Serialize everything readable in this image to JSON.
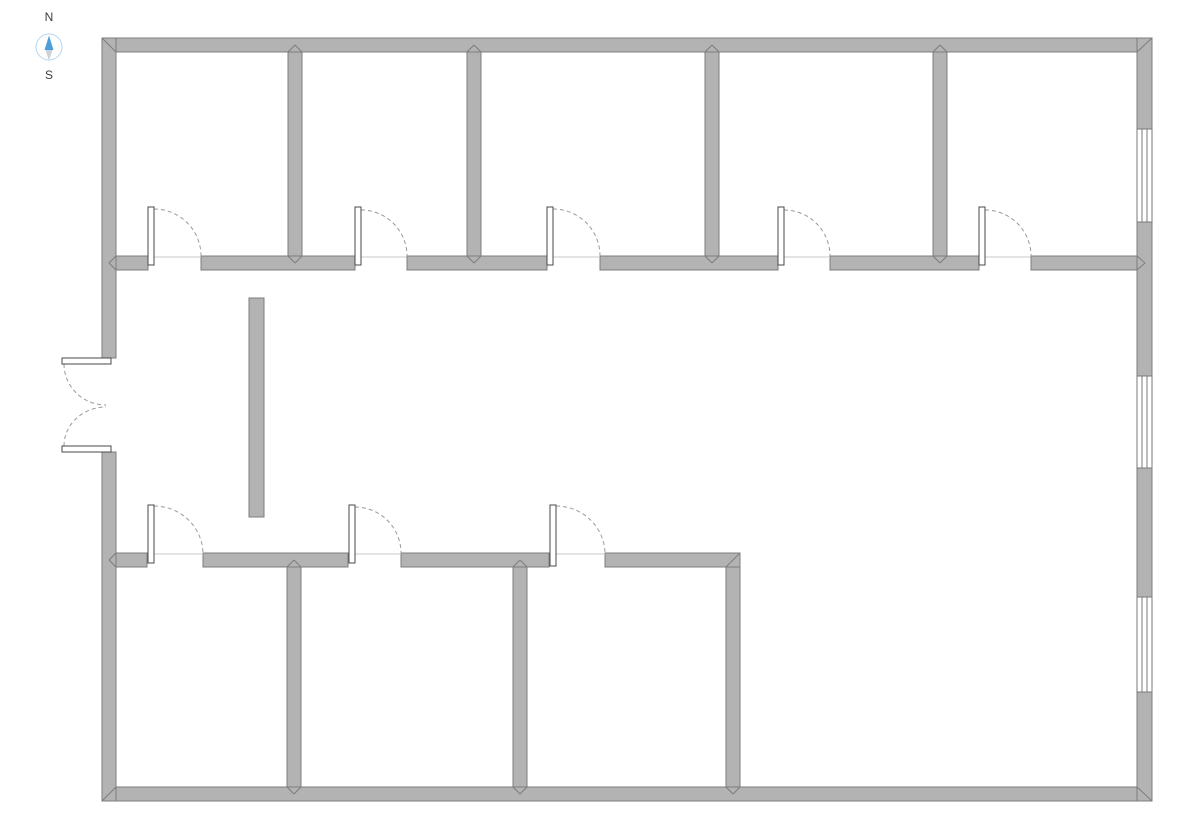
{
  "canvas": {
    "width": 1191,
    "height": 831,
    "background": "#ffffff"
  },
  "colors": {
    "wall_fill": "#b3b3b3",
    "wall_stroke": "#7d7d7d",
    "door_leaf_fill": "#ffffff",
    "door_leaf_stroke": "#4a4a4a",
    "door_arc": "#9a9a9a",
    "opening_line": "#c8c8c8",
    "window_fill": "#ffffff",
    "window_stroke": "#787878",
    "compass_circle": "#b3d6ef",
    "compass_north": "#4ba0da",
    "compass_south": "#ccd1d5",
    "compass_text": "#3e3e3e"
  },
  "compass": {
    "cx": 49,
    "cy": 47,
    "r": 13,
    "north_label": "N",
    "south_label": "S",
    "north_points": "49,35.5 44.5,50 53.5,50",
    "south_points": "45.5,50 52.5,50 49,60.5",
    "north_label_pos": {
      "x": 49,
      "y": 21
    },
    "south_label_pos": {
      "x": 49,
      "y": 79
    },
    "font_size": 12
  },
  "floorplan": {
    "walls": [
      {
        "id": "exterior-top",
        "x": 102,
        "y": 38,
        "w": 1050,
        "h": 14
      },
      {
        "id": "exterior-bottom",
        "x": 102,
        "y": 787,
        "w": 1050,
        "h": 14
      },
      {
        "id": "exterior-left-upper",
        "x": 102,
        "y": 38,
        "w": 14,
        "h": 320
      },
      {
        "id": "exterior-left-lower",
        "x": 102,
        "y": 452,
        "w": 14,
        "h": 349
      },
      {
        "id": "exterior-right",
        "x": 1137,
        "y": 38,
        "w": 15,
        "h": 763
      },
      {
        "id": "corridor-left-stub",
        "x": 116,
        "y": 256,
        "w": 32,
        "h": 14
      },
      {
        "id": "corridor-seg-1",
        "x": 201,
        "y": 256,
        "w": 154,
        "h": 14
      },
      {
        "id": "corridor-seg-2",
        "x": 407,
        "y": 256,
        "w": 140,
        "h": 14
      },
      {
        "id": "corridor-seg-3",
        "x": 600,
        "y": 256,
        "w": 178,
        "h": 14
      },
      {
        "id": "corridor-seg-4",
        "x": 830,
        "y": 256,
        "w": 149,
        "h": 14
      },
      {
        "id": "corridor-seg-5",
        "x": 1031,
        "y": 256,
        "w": 106,
        "h": 14
      },
      {
        "id": "north-partition-1",
        "x": 288,
        "y": 52,
        "w": 14,
        "h": 204
      },
      {
        "id": "north-partition-2",
        "x": 467,
        "y": 52,
        "w": 14,
        "h": 204
      },
      {
        "id": "north-partition-3",
        "x": 705,
        "y": 52,
        "w": 14,
        "h": 204
      },
      {
        "id": "north-partition-4",
        "x": 933,
        "y": 52,
        "w": 14,
        "h": 204
      },
      {
        "id": "south-wing-left-stub",
        "x": 116,
        "y": 553,
        "w": 31,
        "h": 14
      },
      {
        "id": "south-wing-seg-1",
        "x": 203,
        "y": 553,
        "w": 145,
        "h": 14
      },
      {
        "id": "south-wing-seg-2",
        "x": 401,
        "y": 553,
        "w": 148,
        "h": 14
      },
      {
        "id": "south-wing-seg-3",
        "x": 605,
        "y": 553,
        "w": 135,
        "h": 14
      },
      {
        "id": "south-partition-1",
        "x": 287,
        "y": 567,
        "w": 14,
        "h": 220
      },
      {
        "id": "south-partition-2",
        "x": 513,
        "y": 567,
        "w": 14,
        "h": 220
      },
      {
        "id": "south-wing-right",
        "x": 726,
        "y": 567,
        "w": 14,
        "h": 220
      },
      {
        "id": "free-standing-wall",
        "x": 249,
        "y": 298,
        "w": 15,
        "h": 219
      }
    ],
    "miters": [
      [
        102,
        38,
        116,
        52
      ],
      [
        1152,
        38,
        1137,
        52
      ],
      [
        102,
        801,
        116,
        787
      ],
      [
        1152,
        801,
        1137,
        787
      ],
      [
        288,
        52,
        295,
        45
      ],
      [
        302,
        52,
        295,
        45
      ],
      [
        467,
        52,
        474,
        45
      ],
      [
        481,
        52,
        474,
        45
      ],
      [
        705,
        52,
        712,
        45
      ],
      [
        719,
        52,
        712,
        45
      ],
      [
        933,
        52,
        940,
        45
      ],
      [
        947,
        52,
        940,
        45
      ],
      [
        288,
        256,
        295,
        263
      ],
      [
        302,
        256,
        295,
        263
      ],
      [
        467,
        256,
        474,
        263
      ],
      [
        481,
        256,
        474,
        263
      ],
      [
        705,
        256,
        712,
        263
      ],
      [
        719,
        256,
        712,
        263
      ],
      [
        933,
        256,
        940,
        263
      ],
      [
        947,
        256,
        940,
        263
      ],
      [
        116,
        256,
        109,
        263
      ],
      [
        116,
        270,
        109,
        263
      ],
      [
        1137,
        256,
        1145,
        263
      ],
      [
        1137,
        270,
        1145,
        263
      ],
      [
        116,
        553,
        109,
        560
      ],
      [
        116,
        567,
        109,
        560
      ],
      [
        287,
        567,
        294,
        560
      ],
      [
        301,
        567,
        294,
        560
      ],
      [
        513,
        567,
        520,
        560
      ],
      [
        527,
        567,
        520,
        560
      ],
      [
        287,
        787,
        294,
        794
      ],
      [
        301,
        787,
        294,
        794
      ],
      [
        513,
        787,
        520,
        794
      ],
      [
        527,
        787,
        520,
        794
      ],
      [
        726,
        787,
        733,
        794
      ],
      [
        740,
        787,
        733,
        794
      ],
      [
        740,
        553,
        726,
        567
      ]
    ],
    "windows": [
      {
        "id": "east-window-1",
        "x": 1137,
        "y": 129,
        "w": 15,
        "h": 93
      },
      {
        "id": "east-window-2",
        "x": 1137,
        "y": 376,
        "w": 15,
        "h": 92
      },
      {
        "id": "east-window-3",
        "x": 1137,
        "y": 597,
        "w": 15,
        "h": 95
      }
    ],
    "doors": [
      {
        "id": "north-room-1-door",
        "leaf": {
          "x": 148,
          "y": 207,
          "w": 6,
          "h": 58
        },
        "arc": "M154 209 A47 47 0 0 1 201 256",
        "sill": {
          "x1": 148,
          "y1": 257,
          "x2": 201,
          "y2": 257
        }
      },
      {
        "id": "north-room-2-door",
        "leaf": {
          "x": 355,
          "y": 207,
          "w": 6,
          "h": 58
        },
        "arc": "M361 210 A46 46 0 0 1 407 256",
        "sill": {
          "x1": 355,
          "y1": 257,
          "x2": 407,
          "y2": 257
        }
      },
      {
        "id": "north-room-3-door",
        "leaf": {
          "x": 547,
          "y": 207,
          "w": 6,
          "h": 58
        },
        "arc": "M553 209 A47 47 0 0 1 600 256",
        "sill": {
          "x1": 547,
          "y1": 257,
          "x2": 600,
          "y2": 257
        }
      },
      {
        "id": "north-room-4-door",
        "leaf": {
          "x": 778,
          "y": 207,
          "w": 6,
          "h": 58
        },
        "arc": "M784 210 A46 46 0 0 1 830 256",
        "sill": {
          "x1": 778,
          "y1": 257,
          "x2": 830,
          "y2": 257
        }
      },
      {
        "id": "north-room-5-door",
        "leaf": {
          "x": 979,
          "y": 207,
          "w": 6,
          "h": 58
        },
        "arc": "M985 210 A46 46 0 0 1 1031 256",
        "sill": {
          "x1": 979,
          "y1": 257,
          "x2": 1031,
          "y2": 257
        }
      },
      {
        "id": "south-room-1-door",
        "leaf": {
          "x": 148,
          "y": 505,
          "w": 6,
          "h": 58
        },
        "arc": "M154 506 A49 48 0 0 1 203 554",
        "sill": {
          "x1": 148,
          "y1": 554,
          "x2": 203,
          "y2": 554
        }
      },
      {
        "id": "south-room-2-door",
        "leaf": {
          "x": 349,
          "y": 505,
          "w": 6,
          "h": 58
        },
        "arc": "M355 507 A46 46 0 0 1 401 553",
        "sill": {
          "x1": 349,
          "y1": 554,
          "x2": 401,
          "y2": 554
        }
      },
      {
        "id": "south-room-3-door",
        "leaf": {
          "x": 550,
          "y": 505,
          "w": 6,
          "h": 61
        },
        "arc": "M556 506 A49 48 0 0 1 605 554",
        "sill": {
          "x1": 550,
          "y1": 554,
          "x2": 605,
          "y2": 554
        }
      },
      {
        "id": "entrance-door-north-leaf",
        "leaf": {
          "x": 62,
          "y": 358,
          "w": 49,
          "h": 6
        },
        "arc": "M64 364 A42 41 0 0 0 106 405"
      },
      {
        "id": "entrance-door-south-leaf",
        "leaf": {
          "x": 62,
          "y": 446,
          "w": 49,
          "h": 6
        },
        "arc": "M64 446 A42 39 0 0 1 106 407"
      }
    ]
  }
}
